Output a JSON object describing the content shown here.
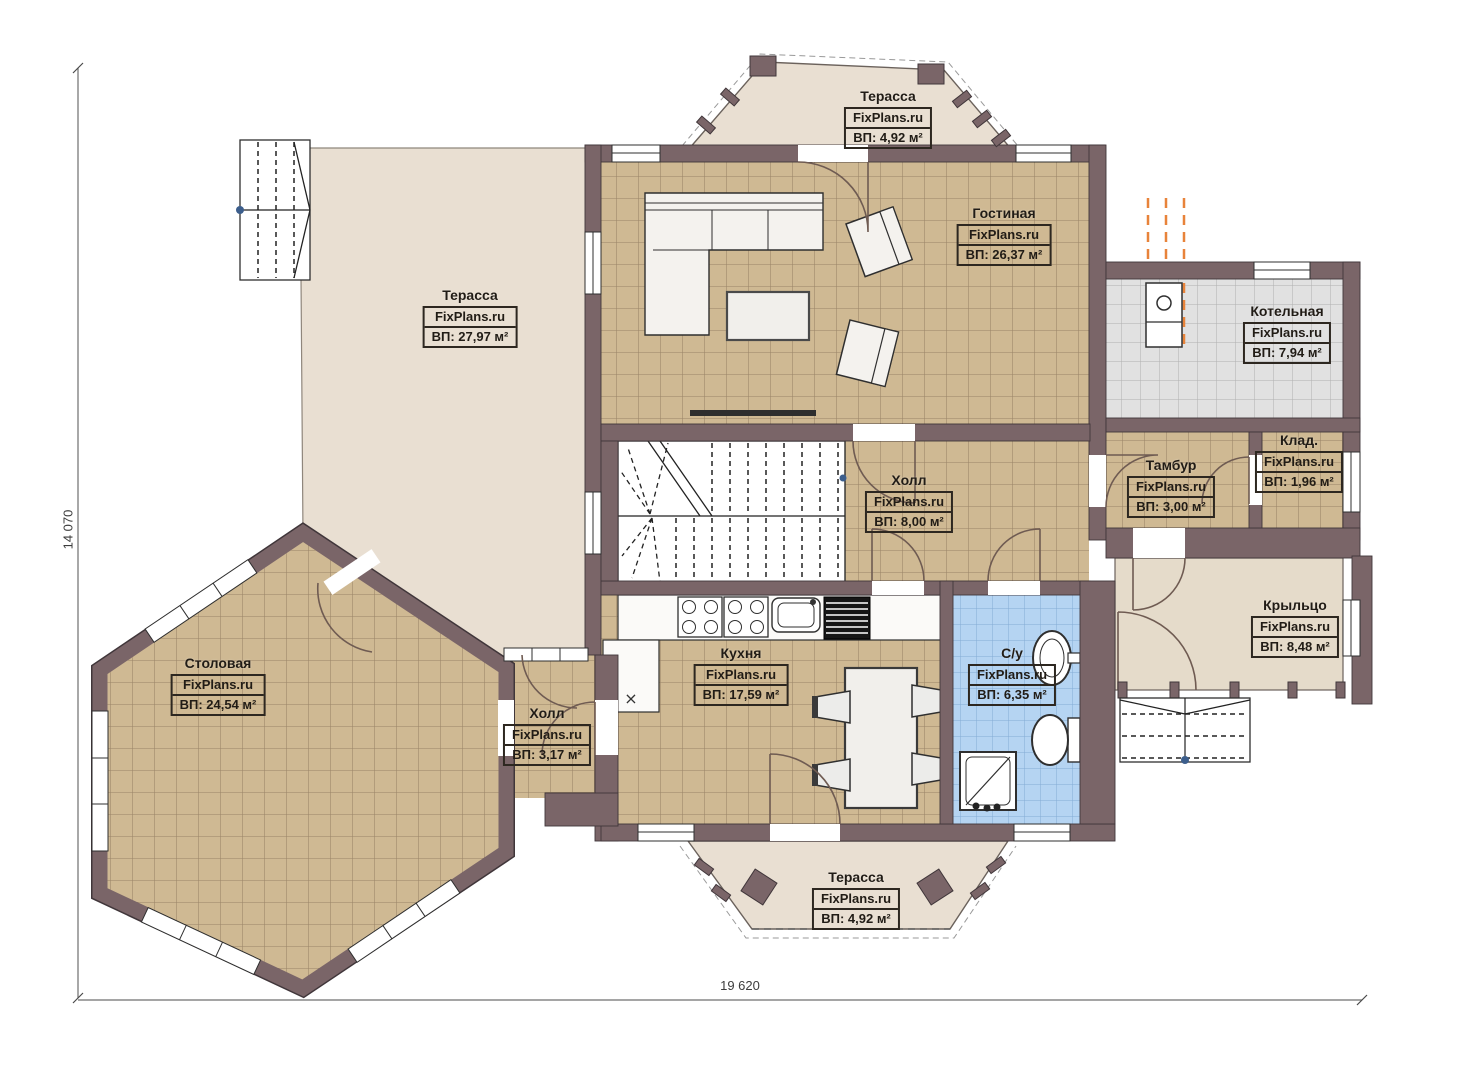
{
  "plan": {
    "brand": "FixPlans.ru",
    "dimensions": {
      "vertical": "14 070",
      "horizontal": "19 620"
    },
    "rooms": {
      "terrace_top": {
        "name": "Терасса",
        "area": "ВП: 4,92 м²"
      },
      "living": {
        "name": "Гостиная",
        "area": "ВП: 26,37 м²"
      },
      "boiler": {
        "name": "Котельная",
        "area": "ВП: 7,94 м²"
      },
      "storage": {
        "name": "Клад.",
        "area": "ВП: 1,96 м²"
      },
      "vestibule": {
        "name": "Тамбур",
        "area": "ВП: 3,00 м²"
      },
      "hall_main": {
        "name": "Холл",
        "area": "ВП: 8,00 м²"
      },
      "kitchen": {
        "name": "Кухня",
        "area": "ВП: 17,59 м²"
      },
      "bathroom": {
        "name": "С/у",
        "area": "ВП: 6,35 м²"
      },
      "porch": {
        "name": "Крыльцо",
        "area": "ВП: 8,48 м²"
      },
      "terrace_left": {
        "name": "Терасса",
        "area": "ВП: 27,97 м²"
      },
      "dining": {
        "name": "Столовая",
        "area": "ВП: 24,54 м²"
      },
      "hall_small": {
        "name": "Холл",
        "area": "ВП: 3,17 м²"
      },
      "terrace_bottom": {
        "name": "Терасса",
        "area": "ВП: 4,92 м²"
      }
    },
    "colors": {
      "wall": "#7a6568",
      "floor_tile": "#cfb993",
      "terrace_floor": "#e9dfd2",
      "porch_floor": "#e5dbca",
      "bathroom_tile": "#b5d4f2",
      "boiler_tile": "#e1e1e1",
      "flue_orange": "#e8833a"
    }
  }
}
